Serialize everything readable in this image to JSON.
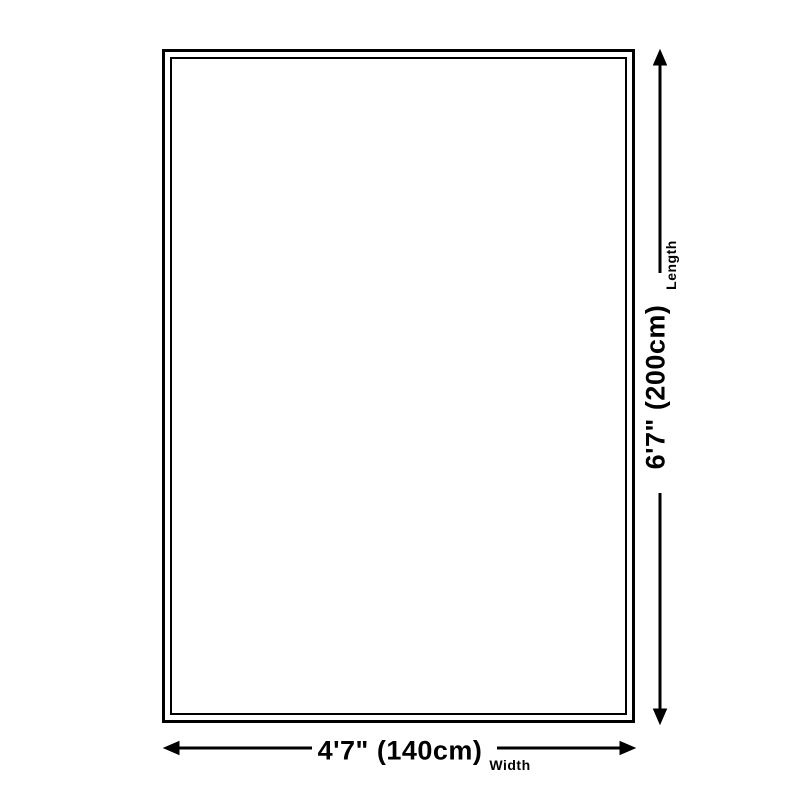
{
  "diagram": {
    "length": {
      "value": "6'7\" (200cm)",
      "label": "Length"
    },
    "width": {
      "value": "4'7\" (140cm)",
      "label": "Width"
    }
  },
  "colors": {
    "line": "#000000",
    "background": "#ffffff"
  }
}
